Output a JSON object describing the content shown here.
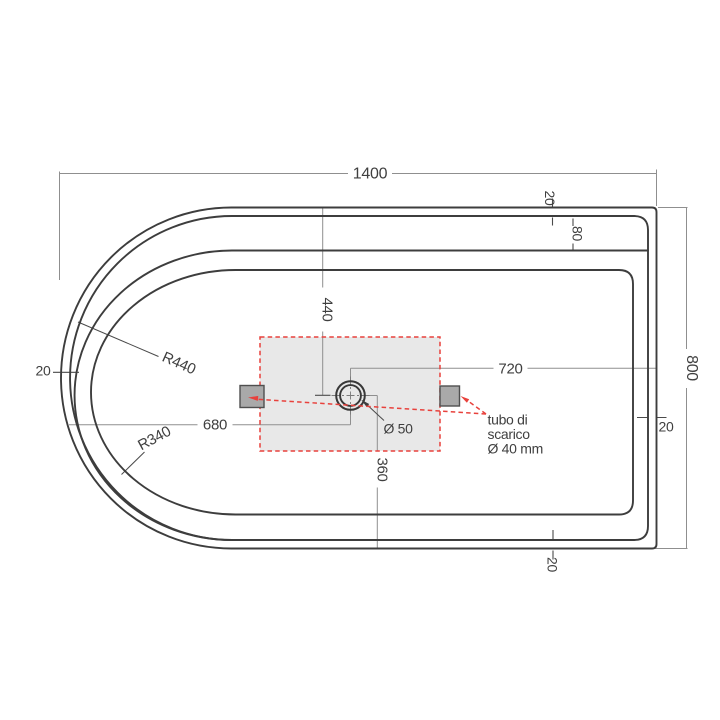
{
  "drawing": {
    "overall_length": "1400",
    "overall_height": "800",
    "rim_top": "20",
    "ledge_depth": "80",
    "rim_right": "20",
    "rim_bottom": "20",
    "rim_left": "20",
    "drain_offset_top": "440",
    "drain_offset_right": "720",
    "drain_offset_left": "680",
    "drain_offset_bottom": "360",
    "outer_radius_label": "R440",
    "inner_radius_label": "R340",
    "drain_diameter_label": "Ø 50",
    "drain_callout": {
      "line1": "tubo di",
      "line2": "scarico",
      "line3": "Ø 40 mm"
    },
    "colors": {
      "outline": "#3d3d3d",
      "dimension_line": "#8f8f8f",
      "dimension_text": "#3f3f3f",
      "accent_red": "#e8413c",
      "zone_fill": "#e8e8e8",
      "marker_fill": "#a9a9a9"
    }
  }
}
